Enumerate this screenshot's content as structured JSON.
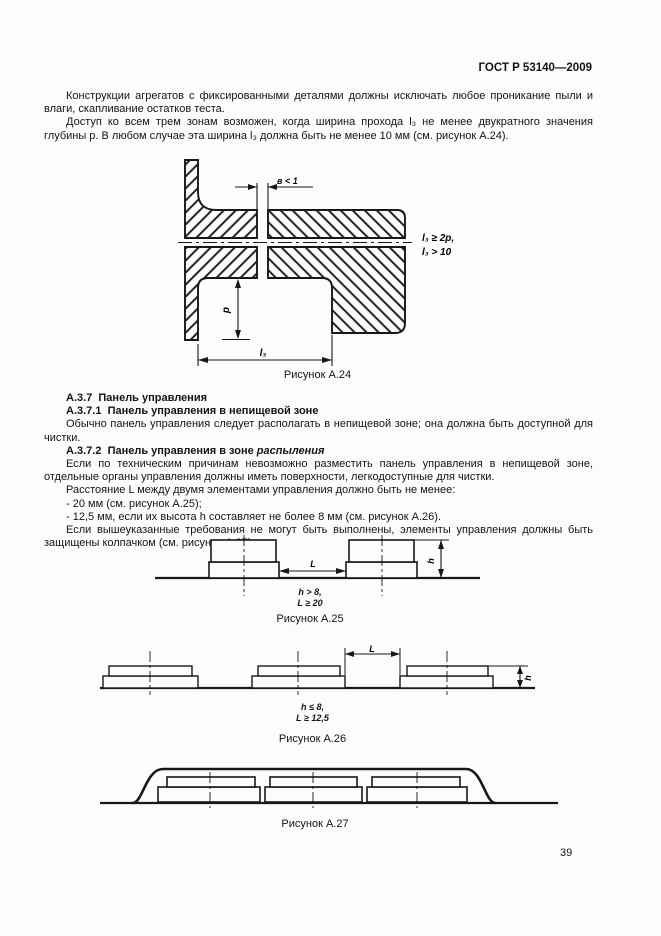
{
  "header": {
    "doc_number": "ГОСТ Р 53140—2009"
  },
  "intro": {
    "p1": "Конструкции агрегатов с фиксированными деталями должны исключать любое проникание пыли и влаги, скапливание остатков теста.",
    "p2": "Доступ ко всем трем зонам возможен, когда ширина прохода l₃ не менее двукратного значения глубины p. В любом случае эта ширина l₃ должна быть не менее 10 мм (см. рисунок А.24)."
  },
  "figure_a24": {
    "gap_label": "в < 1",
    "note_line1": "l₃ ≥ 2p,",
    "note_line2": "l₃ > 10",
    "depth_label": "p",
    "width_label": "l₃",
    "caption": "Рисунок А.24"
  },
  "section": {
    "h_337": "А.3.7  Панель управления",
    "h_3371": "А.3.7.1  Панель управления в непищевой зоне",
    "p_3371": "Обычно панель управления следует располагать в непищевой зоне; она должна быть доступной для чистки.",
    "h_3372_prefix": "А.3.7.2  Панель управления в зоне ",
    "h_3372_italic": "распыления",
    "p_3372_1": "Если по техническим причинам невозможно разместить панель управления в непищевой зоне, отдельные органы управления должны иметь поверхности, легкодоступные для чистки.",
    "p_3372_2": "Расстояние L между двумя элементами управления должно быть не менее:",
    "item1": "- 20 мм (см. рисунок А.25);",
    "item2": "- 12,5 мм, если их высота h составляет не более 8 мм (см. рисунок А.26).",
    "p_3372_3": "Если вышеуказанные требования не могут быть выполнены, элементы управления должны быть защищены колпачком (см. рисунок А.27)."
  },
  "figure_a25": {
    "distance_label": "L",
    "height_label": "h",
    "cond_line1": "h > 8,",
    "cond_line2": "L ≥ 20",
    "caption": "Рисунок А.25"
  },
  "figure_a26": {
    "distance_label": "L",
    "height_label": "h",
    "cond_line1": "h ≤ 8,",
    "cond_line2": "L ≥ 12,5",
    "caption": "Рисунок А.26"
  },
  "figure_a27": {
    "caption": "Рисунок А.27"
  },
  "footer": {
    "page_number": "39"
  }
}
